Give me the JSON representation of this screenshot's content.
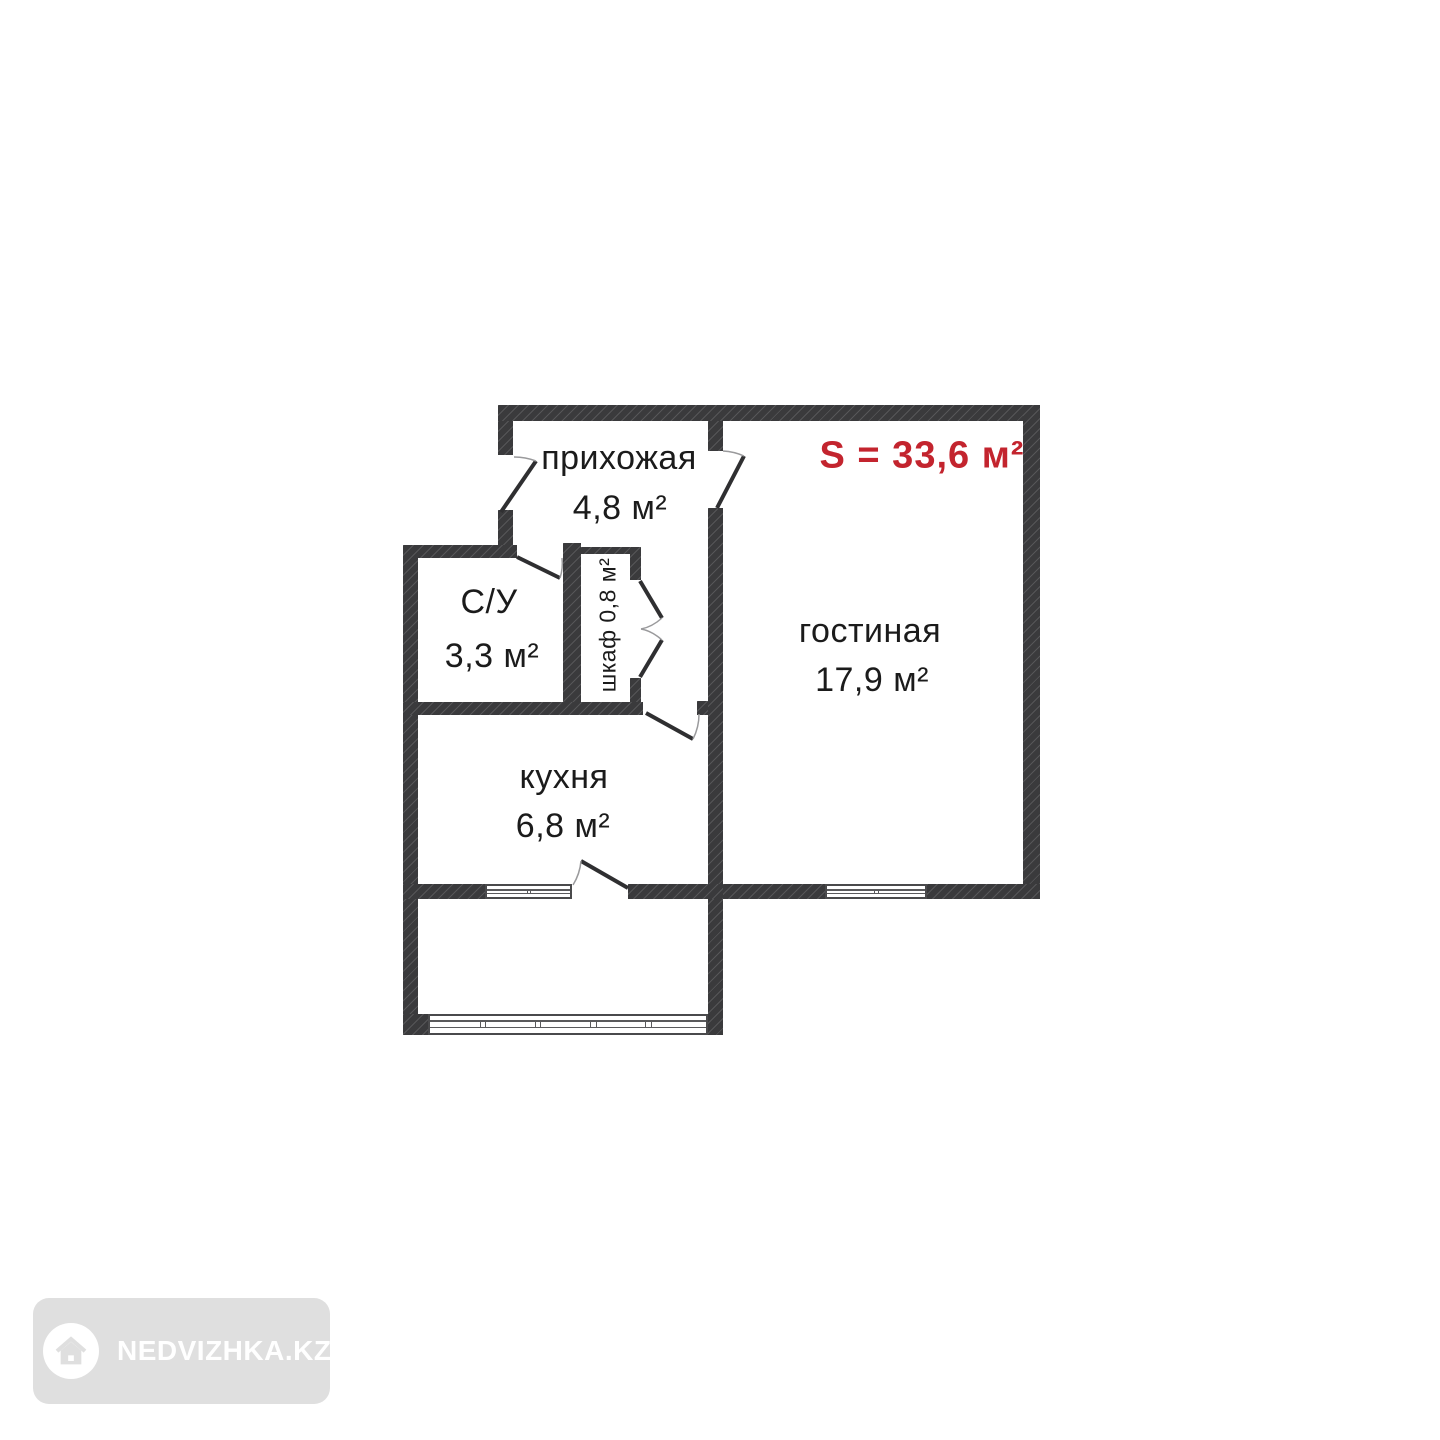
{
  "plan": {
    "total": {
      "label": "S = 33,6 м²"
    },
    "rooms": {
      "hallway": {
        "name": "прихожая",
        "area": "4,8 м²"
      },
      "bathroom": {
        "name": "С/У",
        "area": "3,3 м²"
      },
      "closet": {
        "label": "шкаф 0,8 м²"
      },
      "living_room": {
        "name": "гостиная",
        "area": "17,9 м²"
      },
      "kitchen": {
        "name": "кухня",
        "area": "6,8 м²"
      }
    },
    "colors": {
      "wall": "#3a3a3c",
      "accent_red": "#c3242e",
      "watermark_bg": "#dfdfdf",
      "watermark_fg": "#ffffff"
    },
    "icons": [
      "house-icon"
    ]
  },
  "watermark": {
    "brand": "NEDVIZHKA.KZ"
  }
}
